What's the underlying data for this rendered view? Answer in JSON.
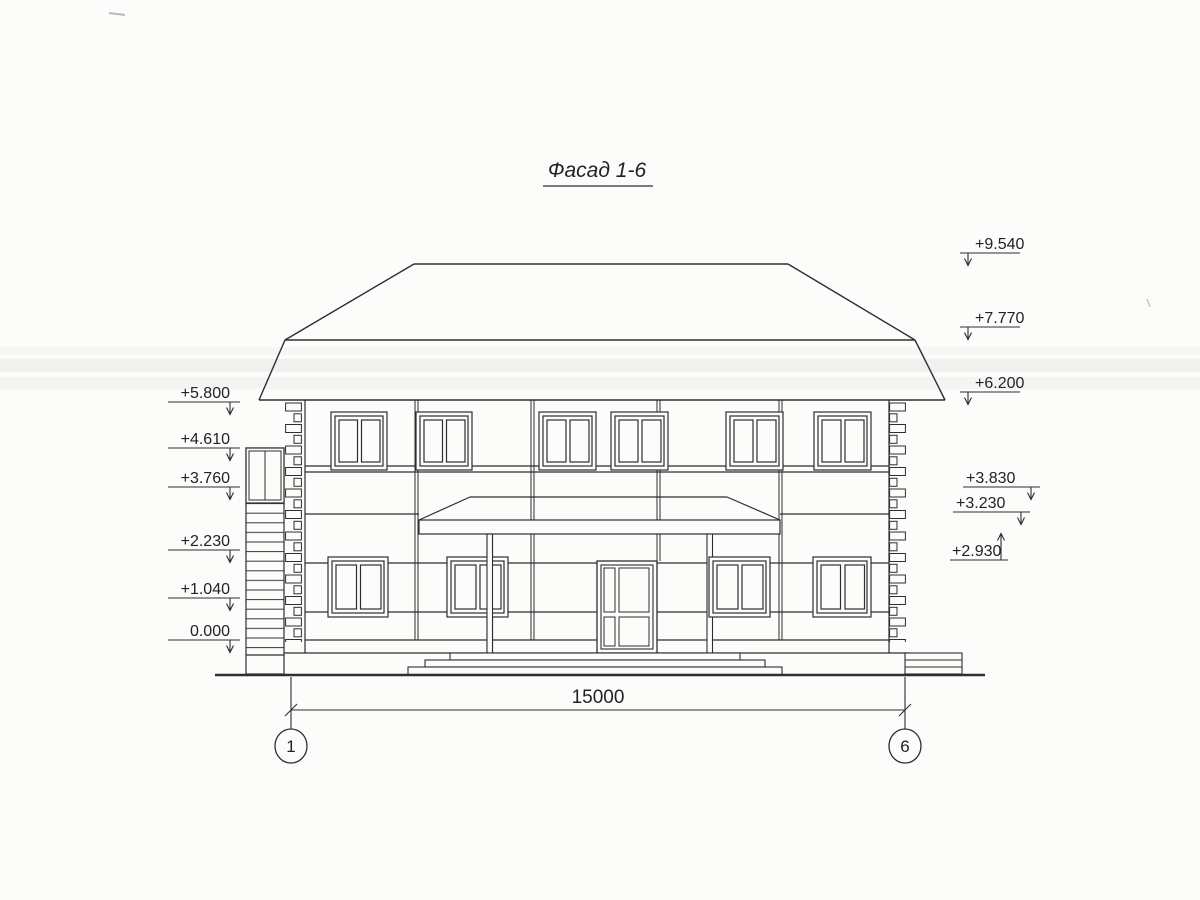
{
  "drawing": {
    "title": "Фасад 1-6",
    "dimension_label": "15000",
    "axis_left": "1",
    "axis_right": "6",
    "elevations_left": [
      "+5.800",
      "+4.610",
      "+3.760",
      "+2.230",
      "+1.040",
      "0.000"
    ],
    "elevations_right": [
      "+9.540",
      "+7.770",
      "+6.200",
      "+3.830",
      "+3.230",
      "+2.930"
    ],
    "colors": {
      "line": "#2e2e2e",
      "paper": "#fcfcfb"
    }
  }
}
